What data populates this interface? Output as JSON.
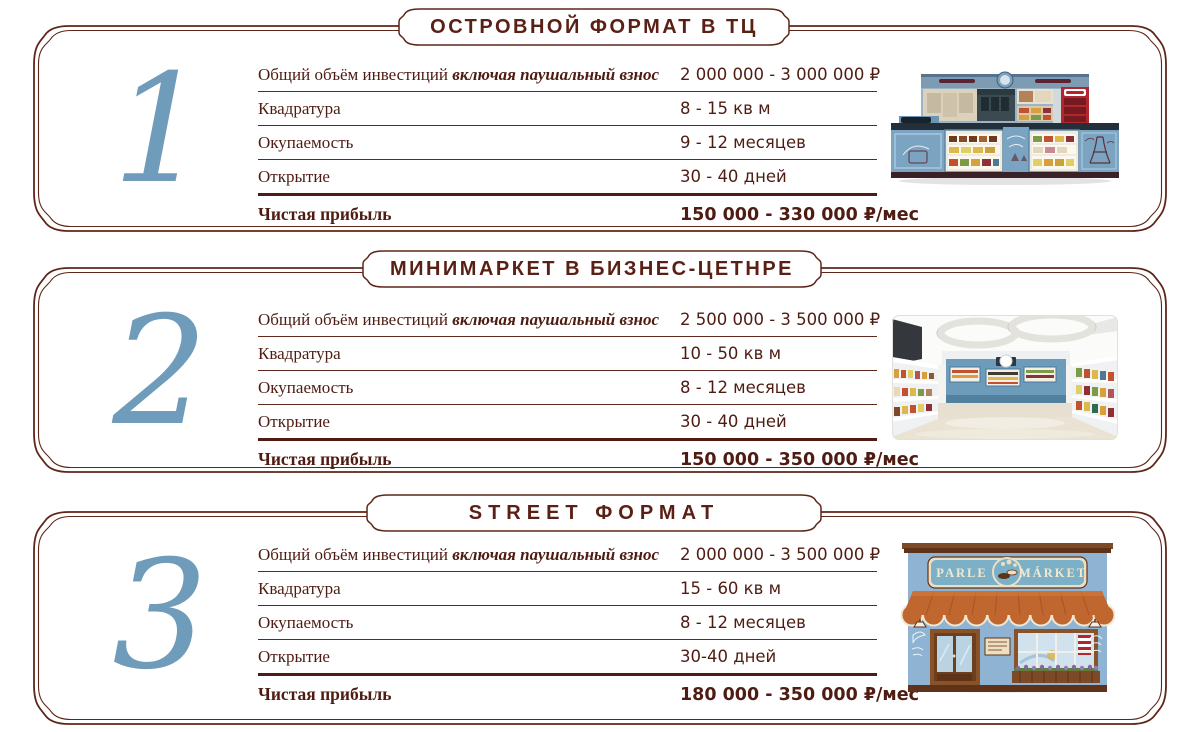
{
  "colors": {
    "text_maroon": "#4e1c12",
    "frame_maroon": "#5e2619",
    "title_maroon": "#5a2015",
    "number_blue": "#6f9cba",
    "kiosk_blue": "#7ba4c2",
    "coke_red": "#b2272e",
    "awning_orange": "#c0662f",
    "facade_blue": "#8fb4d3"
  },
  "sections": [
    {
      "number": "1",
      "title": "ОСТРОВНОЙ ФОРМАТ В ТЦ",
      "illustration": "island-kiosk-in-mall",
      "rows": [
        {
          "label": "Общий объём инвестиций",
          "label_em": "включая паушальный взнос",
          "value": "2 000 000 - 3 000 000 ₽"
        },
        {
          "label": "Квадратура",
          "label_em": "",
          "value": "8 - 15 кв м"
        },
        {
          "label": "Окупаемость",
          "label_em": "",
          "value": "9 - 12 месяцев"
        },
        {
          "label": "Открытие",
          "label_em": "",
          "value": "30 - 40 дней"
        }
      ],
      "profit": {
        "label": "Чистая прибыль",
        "value": "150 000 - 330 000 ₽/мес"
      }
    },
    {
      "number": "2",
      "title": "МИНИМАРКЕТ В БИЗНЕС-ЦЕТНРЕ",
      "illustration": "minimarket-interior-photo",
      "rows": [
        {
          "label": "Общий объём инвестиций",
          "label_em": "включая паушальный взнос",
          "value": "2 500 000 - 3 500 000 ₽"
        },
        {
          "label": "Квадратура",
          "label_em": "",
          "value": "10 - 50 кв м"
        },
        {
          "label": "Окупаемость",
          "label_em": "",
          "value": "8 - 12 месяцев"
        },
        {
          "label": "Открытие",
          "label_em": "",
          "value": "30 - 40 дней"
        }
      ],
      "profit": {
        "label": "Чистая прибыль",
        "value": "150 000 - 350 000 ₽/мес"
      }
    },
    {
      "number": "3",
      "title": "STREET ФОРМАТ",
      "illustration": "street-storefront",
      "rows": [
        {
          "label": "Общий объём инвестиций",
          "label_em": "включая паушальный взнос",
          "value": "2 000 000 - 3 500 000 ₽"
        },
        {
          "label": "Квадратура",
          "label_em": "",
          "value": "15 - 60 кв м"
        },
        {
          "label": "Окупаемость",
          "label_em": "",
          "value": "8 - 12 месяцев"
        },
        {
          "label": "Открытие",
          "label_em": "",
          "value": "30-40 дней"
        }
      ],
      "profit": {
        "label": "Чистая прибыль",
        "value": "180 000 - 350 000 ₽/мес"
      }
    }
  ],
  "storefront_sign": {
    "left": "PARLE",
    "right": "MÁRKET"
  }
}
